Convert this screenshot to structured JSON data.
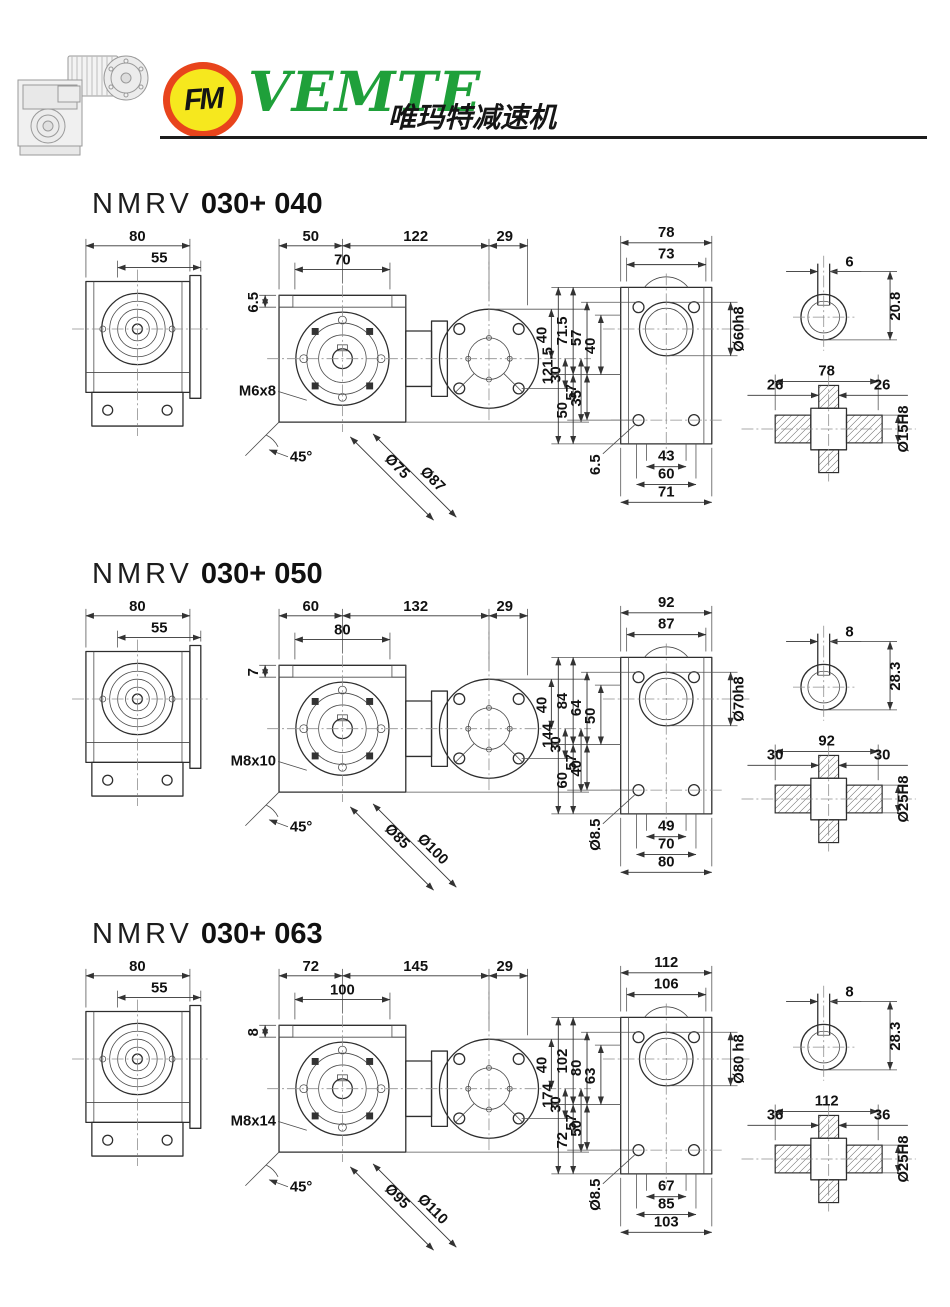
{
  "header": {
    "brand": "VEMTE",
    "brand_cn": "唯玛特减速机",
    "logo_monogram": "FM",
    "colors": {
      "brand_green": "#1fa03a",
      "logo_ring": "#e8441c",
      "logo_fill": "#f6e81e",
      "line_dark": "#1c1c1c"
    },
    "product_image": "worm-gear-reducer-with-motor-photo"
  },
  "sections": [
    {
      "model_prefix": "NMRV",
      "model": "030+ 040",
      "side": {
        "overall": "80",
        "hub": "55"
      },
      "front": {
        "step": "6.5",
        "span_a": "50",
        "span_inner": "70",
        "span_b": "122",
        "span_c": "29",
        "tap": "M6x8",
        "angle": "45°",
        "flange_d1": "Ø75",
        "flange_d2": "Ø87",
        "h_top": "40",
        "h_mid": "30",
        "h_bot": "57"
      },
      "flange": {
        "width": "78",
        "width_inner": "73",
        "bore": "Ø60h8",
        "left": [
          "121.5",
          "71.5",
          "57",
          "40",
          "50",
          "35",
          "6.5"
        ],
        "bottom": [
          "43",
          "60",
          "71"
        ]
      },
      "shaft": {
        "key_width": "6",
        "key_height": "20.8",
        "length": "78",
        "end_left": "26",
        "end_right": "26",
        "dia": "Ø15H8"
      }
    },
    {
      "model_prefix": "NMRV",
      "model": "030+ 050",
      "side": {
        "overall": "80",
        "hub": "55"
      },
      "front": {
        "step": "7",
        "span_a": "60",
        "span_inner": "80",
        "span_b": "132",
        "span_c": "29",
        "tap": "M8x10",
        "angle": "45°",
        "flange_d1": "Ø85",
        "flange_d2": "Ø100",
        "h_top": "40",
        "h_mid": "30",
        "h_bot": "57"
      },
      "flange": {
        "width": "92",
        "width_inner": "87",
        "bore": "Ø70h8",
        "left": [
          "144",
          "84",
          "64",
          "50",
          "60",
          "40",
          "Ø8.5"
        ],
        "bottom": [
          "49",
          "70",
          "80"
        ]
      },
      "shaft": {
        "key_width": "8",
        "key_height": "28.3",
        "length": "92",
        "end_left": "30",
        "end_right": "30",
        "dia": "Ø25H8"
      }
    },
    {
      "model_prefix": "NMRV",
      "model": "030+ 063",
      "side": {
        "overall": "80",
        "hub": "55"
      },
      "front": {
        "step": "8",
        "span_a": "72",
        "span_inner": "100",
        "span_b": "145",
        "span_c": "29",
        "tap": "M8x14",
        "angle": "45°",
        "flange_d1": "Ø95",
        "flange_d2": "Ø110",
        "h_top": "40",
        "h_mid": "30",
        "h_bot": "57"
      },
      "flange": {
        "width": "112",
        "width_inner": "106",
        "bore": "Ø80 h8",
        "left": [
          "174",
          "102",
          "80",
          "63",
          "72",
          "50",
          "Ø8.5"
        ],
        "bottom": [
          "67",
          "85",
          "103"
        ]
      },
      "shaft": {
        "key_width": "8",
        "key_height": "28.3",
        "length": "112",
        "end_left": "36",
        "end_right": "36",
        "dia": "Ø25H8"
      }
    }
  ]
}
